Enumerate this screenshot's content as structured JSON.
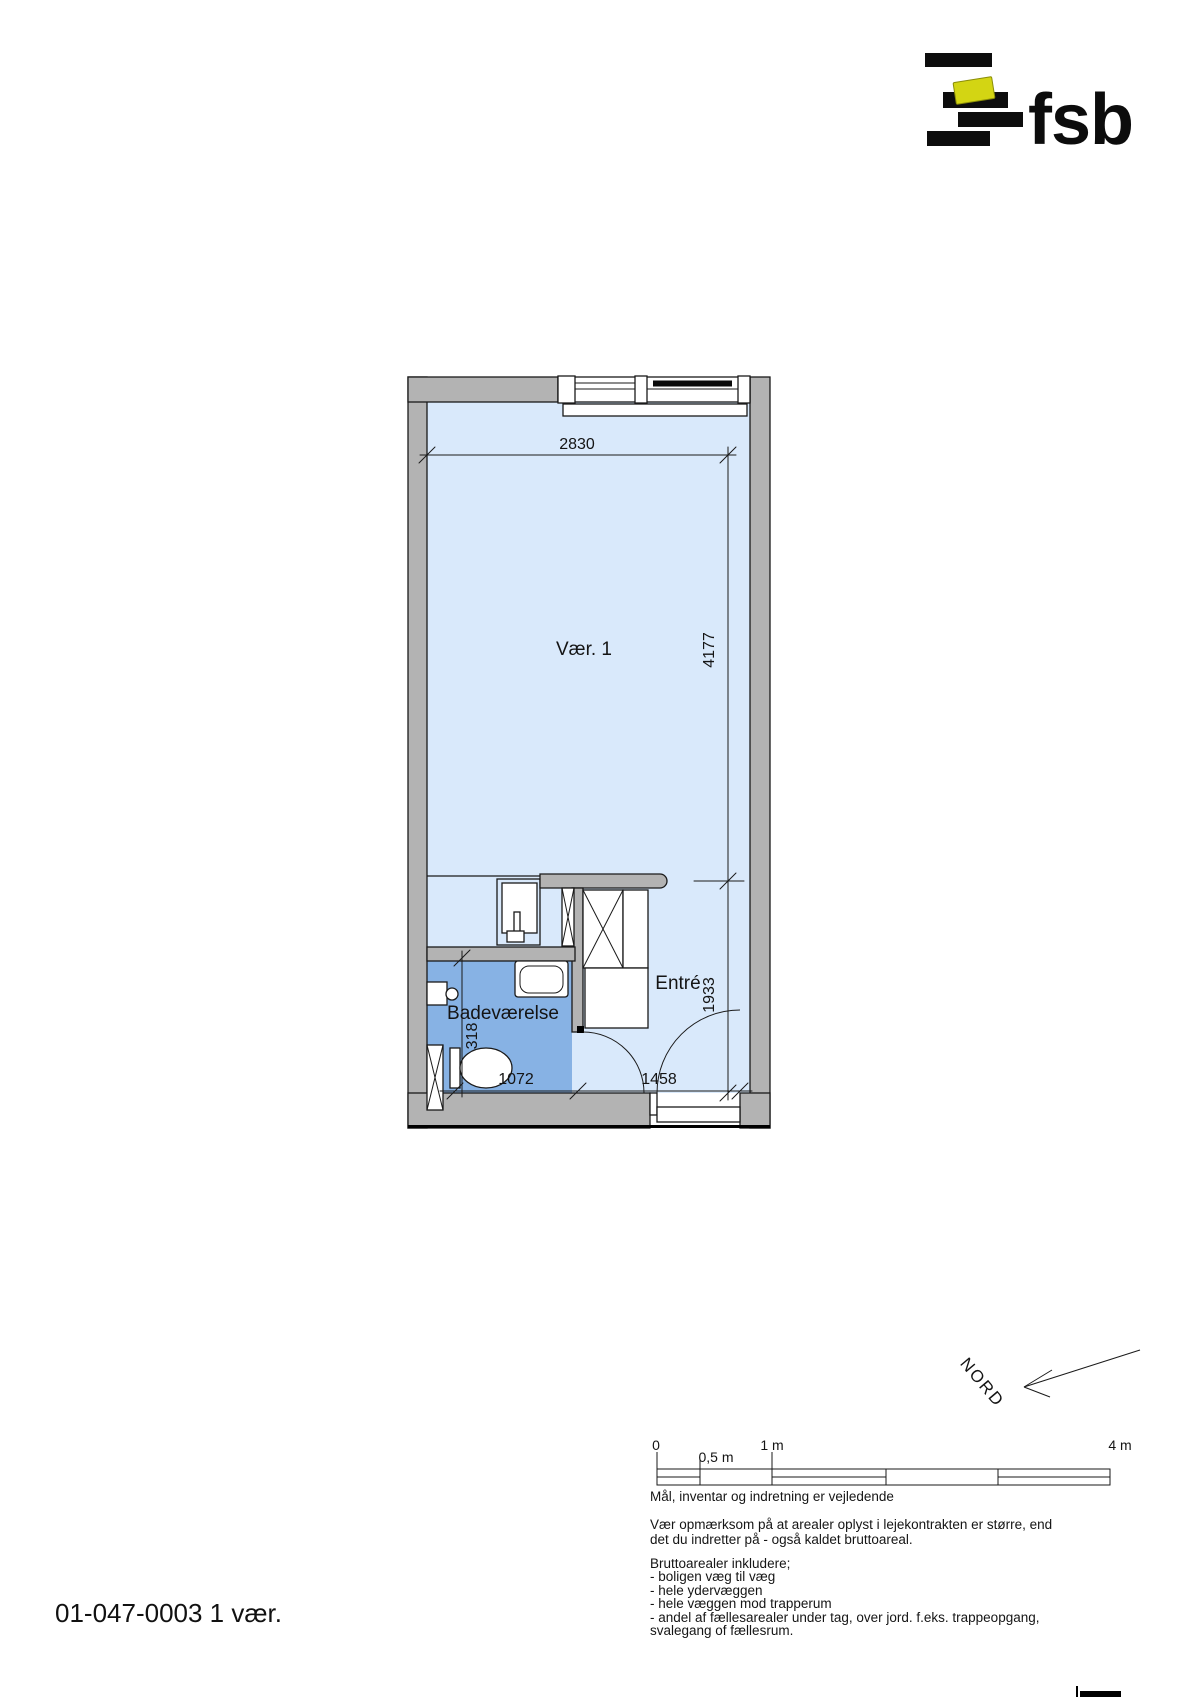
{
  "logo": {
    "brand": "fsb",
    "bar_color": "#0d0d0d",
    "accent_color": "#d3d513"
  },
  "plan": {
    "room1_label": "Vær. 1",
    "bathroom_label": "Badeværelse",
    "entry_label": "Entré",
    "dim_top_width": "2830",
    "dim_room_depth": "4177",
    "dim_entry_depth": "1933",
    "dim_bath_width": "1072",
    "dim_entry_width": "1458",
    "dim_niche": "318",
    "colors": {
      "room_fill": "#d9e9fb",
      "bathroom_fill": "#87b2e4",
      "wall_fill": "#b3b3b3"
    }
  },
  "north": {
    "label": "NORD"
  },
  "scalebar": {
    "label_0": "0",
    "label_05": "0,5 m",
    "label_1": "1 m",
    "label_4": "4 m"
  },
  "notes": {
    "vejledende": "Mål, inventar og indretning er vejledende",
    "para2": [
      "Vær opmærksom på at arealer oplyst i lejekontrakten er større, end",
      "det du indretter på - også kaldet bruttoareal."
    ],
    "para3": [
      "Bruttoarealer inkludere;",
      "- boligen væg til væg",
      "- hele ydervæggen",
      "- hele væggen mod trapperum",
      "- andel af fællesarealer under tag, over jord. f.eks. trappeopgang,",
      "svalegang of fællesrum."
    ]
  },
  "footer": {
    "plan_id": "01-047-0003 1 vær."
  }
}
